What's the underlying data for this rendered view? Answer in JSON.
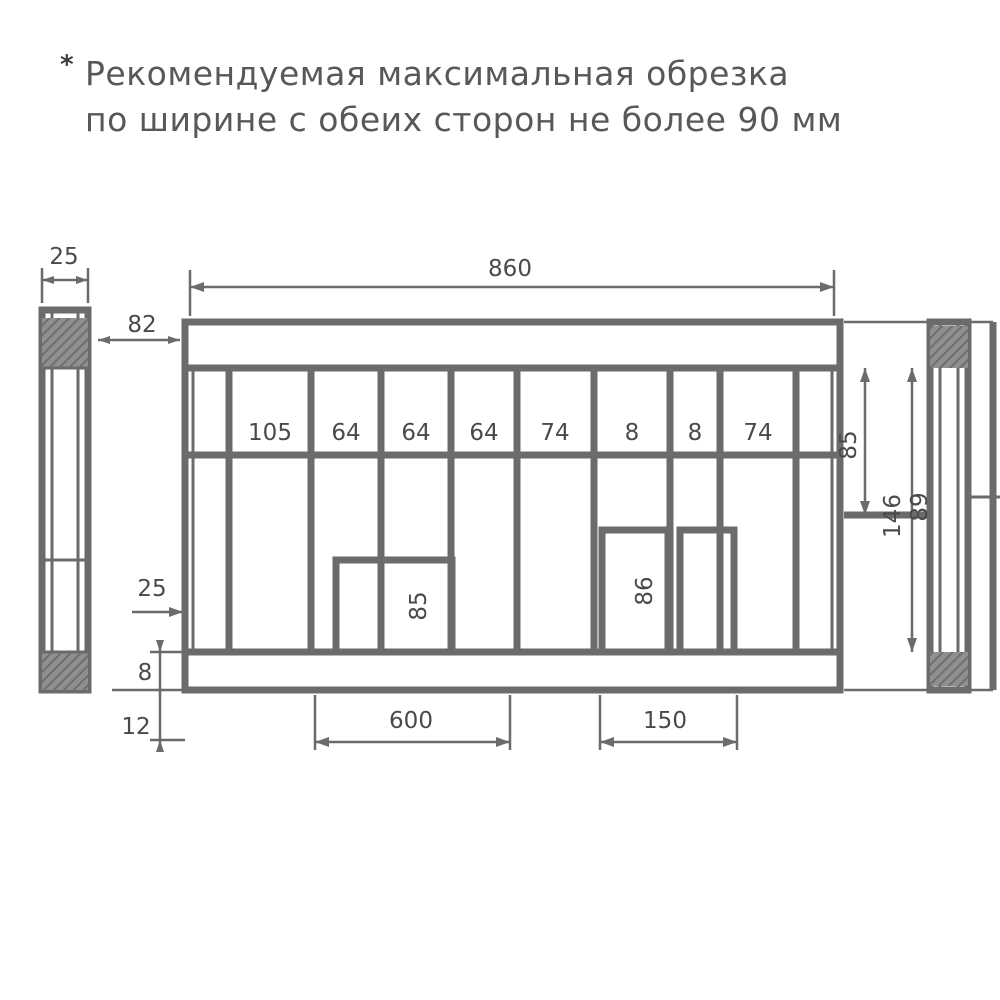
{
  "note": {
    "marker": "*",
    "line1": "Рекомендуемая максимальная обрезка",
    "line2": "по ширине с обеих сторон не более 90 мм"
  },
  "colors": {
    "line": "#6b6b6b",
    "text": "#4a4a4a",
    "note_text": "#585858",
    "background": "#ffffff"
  },
  "drawing": {
    "dim_overall_width": "860",
    "dim_profile_width": "25",
    "dim_side_gap": "82",
    "bay_labels": [
      "105",
      "64",
      "64",
      "64",
      "74",
      "8",
      "8",
      "74"
    ],
    "dim_right_top": "85",
    "dim_right_height": "146",
    "dim_right_inner": "89",
    "dim_opening1_height": "85",
    "dim_opening2_height": "86",
    "dim_left_offset": "25",
    "dim_left_lower": "8",
    "dim_left_bottom": "12",
    "dim_opening1_width": "600",
    "dim_opening2_width": "150"
  }
}
